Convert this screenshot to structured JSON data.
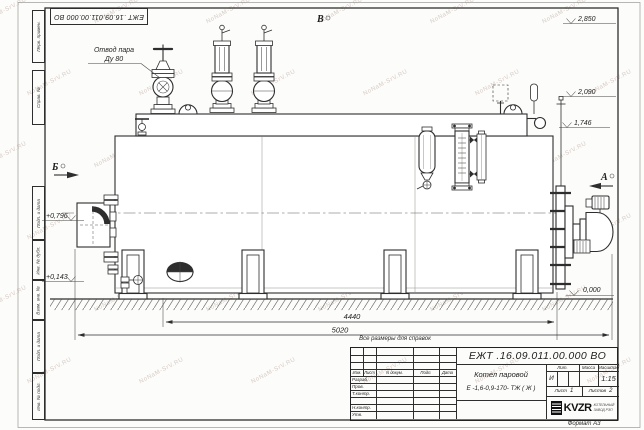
{
  "watermark": {
    "text": "NoNaM-SrV.RU"
  },
  "frame": {
    "stamp_designation": "ЕЖТ .16.09.011.00.000  ВО",
    "side_labels": [
      "Перв. примен.",
      "Справ. №",
      "Подп. и дата",
      "Инв. № дубл.",
      "Взам. инв. №",
      "Подп. и дата",
      "Инв. № подл."
    ],
    "format_label": "Формат А3"
  },
  "drawing": {
    "labels": {
      "steam_line1": "Отвод пара",
      "steam_line2": "Ду 80",
      "view_a": "А",
      "view_b": "Б",
      "view_v": "В",
      "note": "Все размеры для справок"
    },
    "elevations": {
      "e2850": "2,850",
      "e2090": "2,090",
      "e1746": "1,746",
      "e0796": "+0,796",
      "e0143": "+0,143",
      "e0000": "0,000"
    },
    "dimensions": {
      "d4440": "4440",
      "d5020": "5020"
    }
  },
  "title_block": {
    "designation": "ЕЖТ .16.09.011.00.000  ВО",
    "product_name_line1": "Котел паровой",
    "product_name_line2": "Е -1,6-0,9-170- ТЖ ( Ж )",
    "col_headers": [
      "Изм.",
      "Лист",
      "N докум.",
      "Подп.",
      "Дата"
    ],
    "row_labels": [
      "Разраб.",
      "Пров.",
      "Т.контр.",
      "Н.контр.",
      "Утв."
    ],
    "lit_header": "Лит.",
    "mass_header": "Масса",
    "scale_header": "Масштаб",
    "lit_value": "И",
    "scale_value": "1:15",
    "sheet_label": "Лист",
    "sheet_value": "1",
    "sheets_label": "Листов",
    "sheets_value": "2",
    "logo_text": "KVZR",
    "logo_sub_line1": "КОТЕЛЬНЫЙ",
    "logo_sub_line2": "ЗАВОД РЭП"
  }
}
